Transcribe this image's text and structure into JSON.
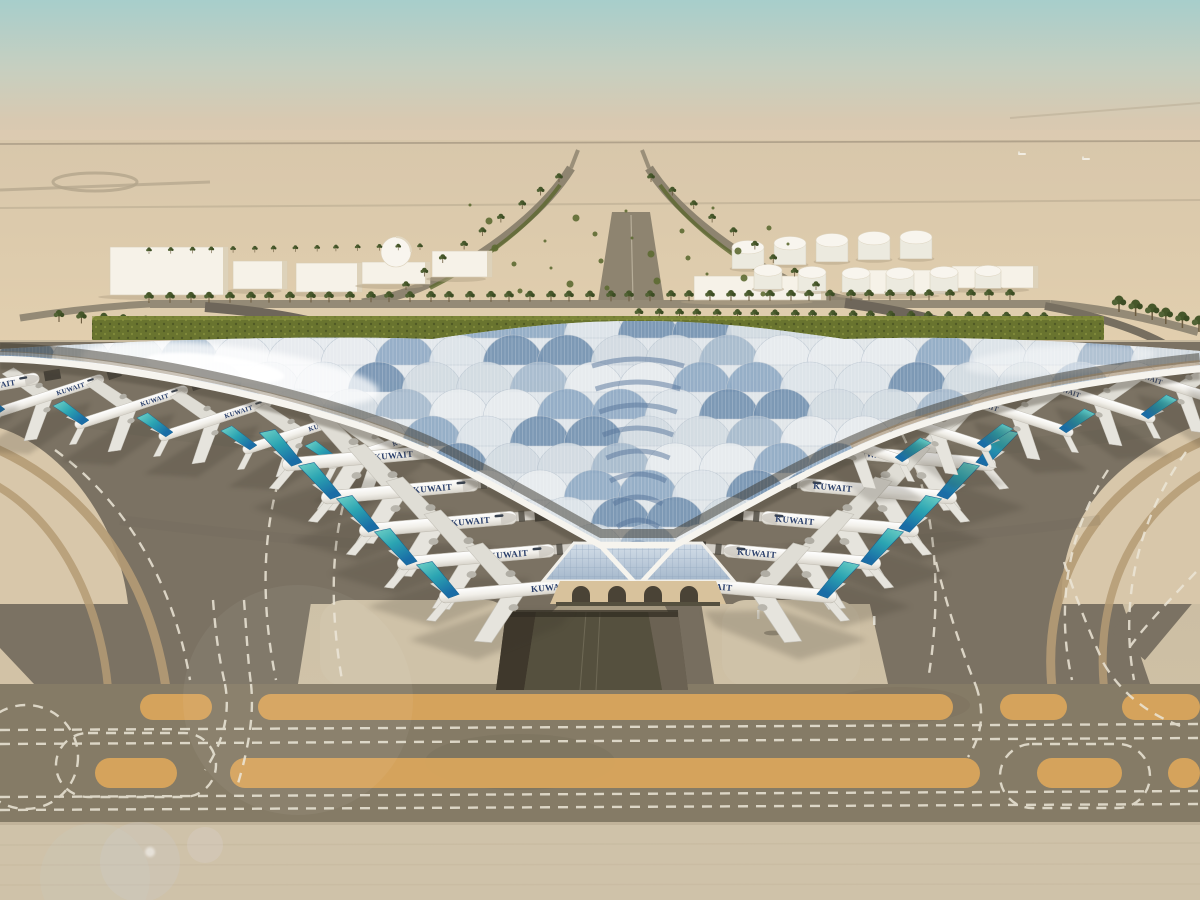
{
  "scene": {
    "description": "Aerial architectural rendering of Kuwait International Airport trefoil terminal with Kuwait Airways aircraft parked at gates, desert背景 apron taxiways and runway markings",
    "sky": {
      "top": "#a7cecb",
      "mid": "#c6cfc0",
      "haze": "#dccab1"
    },
    "sand": {
      "top": "#d8c7ab",
      "bottom": "#e2cfae"
    },
    "hedge_green": "#69742f",
    "palm_green": "#46572a",
    "terminal": {
      "roof_silver": "#e7ebee",
      "roof_blue": "#7f9ab8",
      "rim": "#f6f4ee",
      "glass": "#b9c9da",
      "structure_beige": "#d8c29c"
    },
    "ground": {
      "apron_dark": "#7b7263",
      "concrete_light": "#cbbda2",
      "patch_light": "#cfc2a8",
      "band": "#857b66",
      "stripe_orange": "#d9a55c",
      "dash_white": "#ece6d7",
      "tan_band": "#b59b74",
      "underpass": "#55503e",
      "sand_wedge": "#d8c7aa"
    }
  },
  "airline": {
    "label": "KUWAIT",
    "lettering_color": "#2a3f6b",
    "tail_tip": "#6fd0c6",
    "tail_mid": "#2ba4b2",
    "tail_base": "#1a6da6"
  },
  "planes": {
    "groups": [
      {
        "name": "left-pier-row",
        "flip": false,
        "angle": -18,
        "scale": 0.75,
        "bridge": false,
        "items": [
          [
            48,
            396
          ],
          [
            132,
            407
          ],
          [
            216,
            419
          ],
          [
            300,
            432
          ],
          [
            384,
            447
          ]
        ]
      },
      {
        "name": "far-left-partial",
        "flip": false,
        "angle": -10,
        "scale": 0.9,
        "bridge": false,
        "items": [
          [
            -30,
            390
          ]
        ]
      },
      {
        "name": "left-gates",
        "flip": false,
        "angle": -5,
        "scale": 1.0,
        "bridge": true,
        "items": [
          [
            362,
            458
          ],
          [
            401,
            491
          ],
          [
            439,
            524
          ],
          [
            477,
            557
          ],
          [
            519,
            590
          ]
        ]
      },
      {
        "name": "right-gates",
        "flip": true,
        "angle": -5,
        "scale": 1.0,
        "bridge": true,
        "items": [
          [
            916,
            458
          ],
          [
            877,
            491
          ],
          [
            839,
            524
          ],
          [
            801,
            557
          ],
          [
            757,
            590
          ]
        ]
      },
      {
        "name": "right-pier-row",
        "flip": true,
        "angle": -18,
        "scale": 0.75,
        "bridge": false,
        "items": [
          [
            852,
            444
          ],
          [
            934,
            430
          ],
          [
            1016,
            415
          ],
          [
            1098,
            401
          ],
          [
            1180,
            388
          ]
        ]
      },
      {
        "name": "far-right-partial",
        "flip": true,
        "angle": -10,
        "scale": 0.9,
        "bridge": false,
        "items": [
          [
            1236,
            374
          ]
        ]
      }
    ]
  },
  "background": {
    "buildings": [
      {
        "x": 110,
        "y": 247,
        "w": 118,
        "h": 48
      },
      {
        "x": 233,
        "y": 261,
        "w": 54,
        "h": 28
      },
      {
        "x": 296,
        "y": 263,
        "w": 66,
        "h": 29
      },
      {
        "x": 362,
        "y": 262,
        "w": 68,
        "h": 22,
        "dome": {
          "cx": 396,
          "cy": 252,
          "r": 15
        }
      },
      {
        "x": 432,
        "y": 251,
        "w": 60,
        "h": 26
      },
      {
        "x": 694,
        "y": 276,
        "w": 132,
        "h": 24
      },
      {
        "x": 846,
        "y": 270,
        "w": 104,
        "h": 24
      },
      {
        "x": 952,
        "y": 266,
        "w": 86,
        "h": 22
      }
    ],
    "tanks": [
      [
        748,
        256,
        16
      ],
      [
        790,
        252,
        16
      ],
      [
        832,
        249,
        16
      ],
      [
        874,
        247,
        16
      ],
      [
        916,
        246,
        16
      ],
      [
        768,
        278,
        14
      ],
      [
        812,
        280,
        14
      ],
      [
        856,
        281,
        14
      ],
      [
        900,
        281,
        14
      ],
      [
        944,
        280,
        14
      ],
      [
        988,
        278,
        13
      ]
    ],
    "palm_rows": [
      {
        "x1": 150,
        "y1": 303,
        "x2": 1010,
        "y2": 300,
        "n": 44,
        "s": 1.0
      },
      {
        "x1": 640,
        "y1": 318,
        "x2": 1045,
        "y2": 322,
        "n": 22,
        "s": 0.9
      },
      {
        "x1": 60,
        "y1": 322,
        "x2": 210,
        "y2": 332,
        "n": 8,
        "s": 1.1
      },
      {
        "x1": 1120,
        "y1": 312,
        "x2": 1198,
        "y2": 332,
        "n": 6,
        "s": 1.5
      },
      {
        "x1": 560,
        "y1": 182,
        "x2": 405,
        "y2": 290,
        "n": 9,
        "s": 0.8
      },
      {
        "x1": 652,
        "y1": 182,
        "x2": 815,
        "y2": 290,
        "n": 9,
        "s": 0.8
      },
      {
        "x1": 150,
        "y1": 254,
        "x2": 420,
        "y2": 250,
        "n": 14,
        "s": 0.6
      }
    ],
    "shrub_area": {
      "x": 470,
      "y": 205,
      "w": 330,
      "h": 93,
      "count": 26
    },
    "vehicles": {
      "van": {
        "x": 776,
        "y": 624
      }
    },
    "distant_aircraft": [
      [
        1022,
        154
      ],
      [
        1086,
        159
      ]
    ]
  },
  "markings": {
    "orange_upper": {
      "y": 694,
      "h": 26,
      "segments": [
        [
          140,
          212
        ],
        [
          258,
          953
        ],
        [
          1000,
          1067
        ],
        [
          1122,
          1200
        ]
      ]
    },
    "orange_lower": {
      "y": 758,
      "h": 30,
      "segments": [
        [
          95,
          177
        ],
        [
          230,
          980
        ],
        [
          1037,
          1122
        ],
        [
          1168,
          1200
        ]
      ]
    }
  },
  "roof_style": {
    "row_top": 338,
    "row_step": 27,
    "col_step": 54,
    "radius": 30,
    "rows": 10,
    "silvers": [
      "#e8ecef",
      "#dde4e9",
      "#d2dbe2"
    ],
    "blues": [
      "#8ea9c4",
      "#7391b0",
      "#a5b9cc"
    ],
    "chevron_color": "#56749a"
  }
}
